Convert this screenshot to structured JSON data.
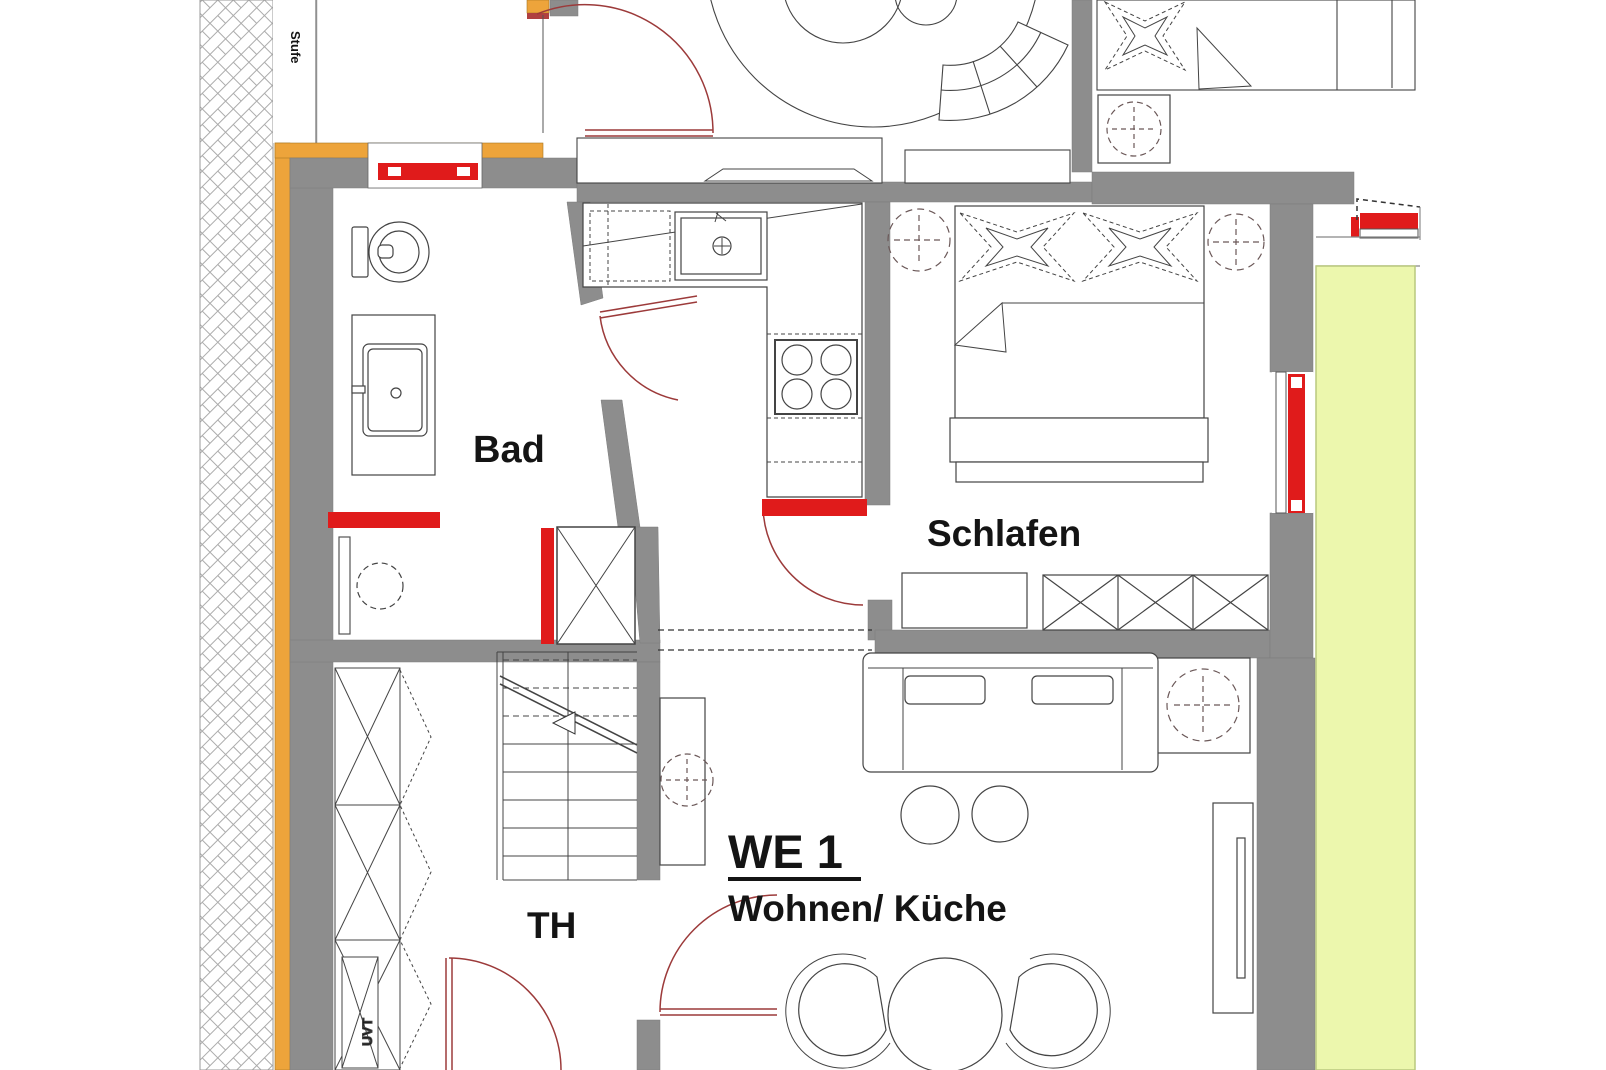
{
  "meta": {
    "type": "architectural floor plan"
  },
  "labels": {
    "unit": "WE 1",
    "room_living_kitchen": "Wohnen/ Küche",
    "room_bedroom": "Schlafen",
    "room_bath": "Bad",
    "stairwell": "TH",
    "step_note": "Stufe",
    "shaft_note": "UVT"
  },
  "colors": {
    "wall_gray": "#8d8d8d",
    "insulation_orange": "#eda43b",
    "element_red": "#e01b1b",
    "door_swing_red": "#9c3a3a",
    "balcony_green": "#ecf7ad",
    "line_dark": "#444444"
  }
}
